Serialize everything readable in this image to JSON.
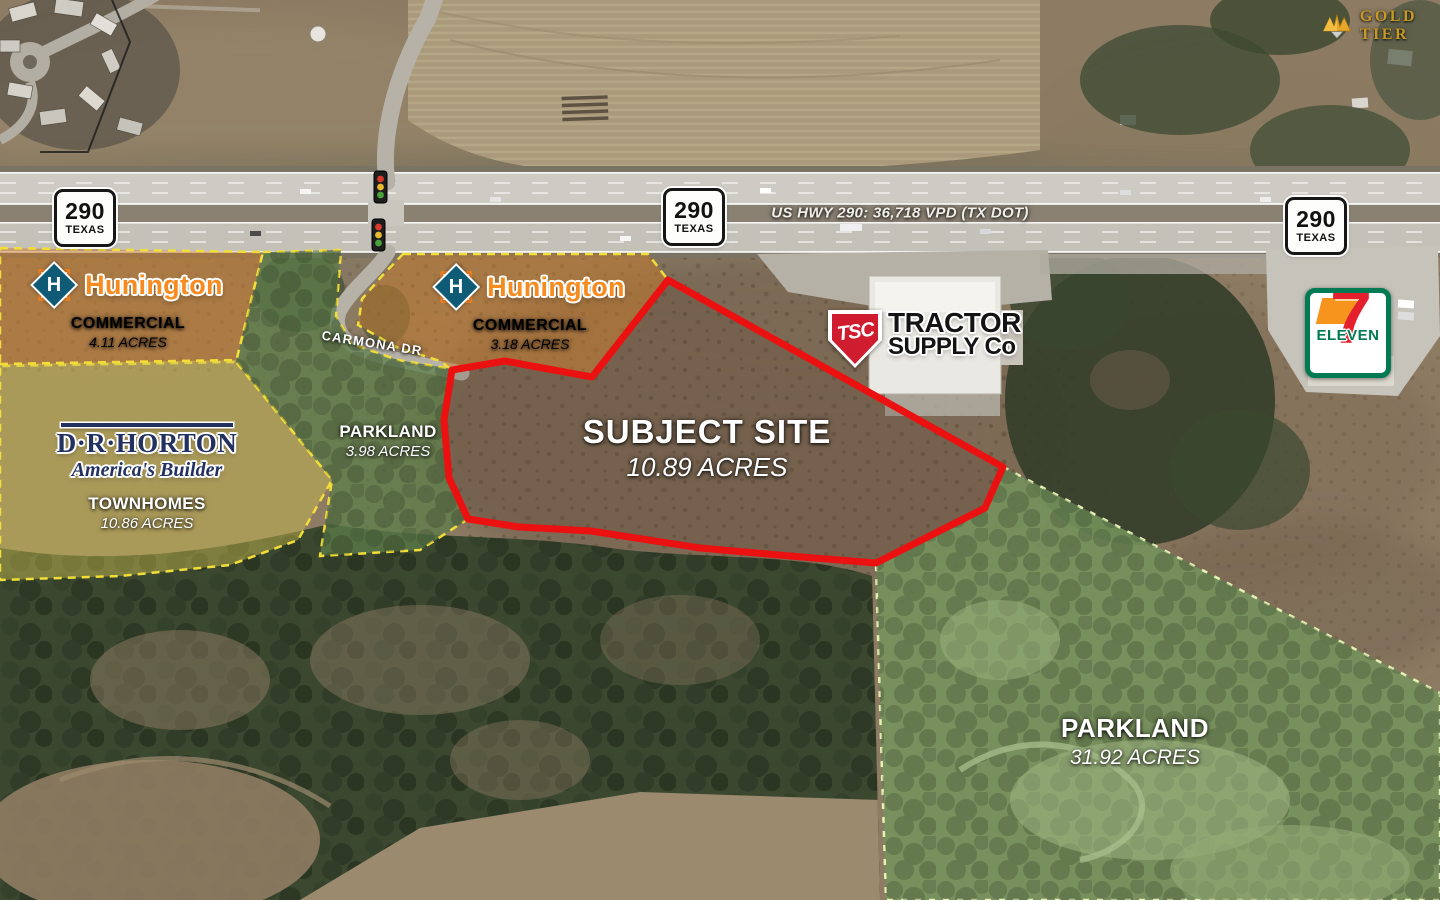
{
  "badge": {
    "label": "GOLD TIER"
  },
  "highway": {
    "traffic_label": "US HWY 290: 36,718 VPD (TX DOT)",
    "shields": [
      {
        "route": "290",
        "state": "TEXAS"
      },
      {
        "route": "290",
        "state": "TEXAS"
      },
      {
        "route": "290",
        "state": "TEXAS"
      }
    ]
  },
  "streets": {
    "carmona_dr": "CARMONA DR"
  },
  "parcels": {
    "hunington_west": {
      "brand": "Hunington",
      "initial": "H",
      "type": "COMMERCIAL",
      "acreage": "4.11 ACRES"
    },
    "hunington_east": {
      "brand": "Hunington",
      "initial": "H",
      "type": "COMMERCIAL",
      "acreage": "3.18 ACRES"
    },
    "dr_horton": {
      "brand": "D·R·HORTON",
      "tagline": "America's Builder",
      "type": "TOWNHOMES",
      "acreage": "10.86 ACRES"
    },
    "parkland_west": {
      "type": "PARKLAND",
      "acreage": "3.98 ACRES"
    },
    "parkland_east": {
      "type": "PARKLAND",
      "acreage": "31.92 ACRES"
    },
    "subject_site": {
      "title": "SUBJECT SITE",
      "acreage": "10.89 ACRES"
    }
  },
  "pois": {
    "tractor_supply": {
      "abbr": "TSC",
      "name_line1": "TRACTOR",
      "name_line2": "SUPPLY Co"
    },
    "seven_eleven": {
      "digit": "7",
      "name": "ELEVEN"
    }
  },
  "colors": {
    "subject_boundary": "#eb1111",
    "commercial_tint": "#c97a28",
    "residential_tint": "#cfc04f",
    "parkland_tint": "#5c7d49",
    "boundary_dash_yellow": "#f2de3a",
    "boundary_dash_green": "#e6f2b4",
    "hunington_orange": "#f68b1f",
    "drhorton_navy": "#22315f",
    "tsc_red": "#cf1c2f",
    "seven_eleven_green": "#007a53",
    "seven_eleven_red": "#e4202e",
    "seven_eleven_orange": "#f7941d",
    "gold": "#c79a25"
  }
}
